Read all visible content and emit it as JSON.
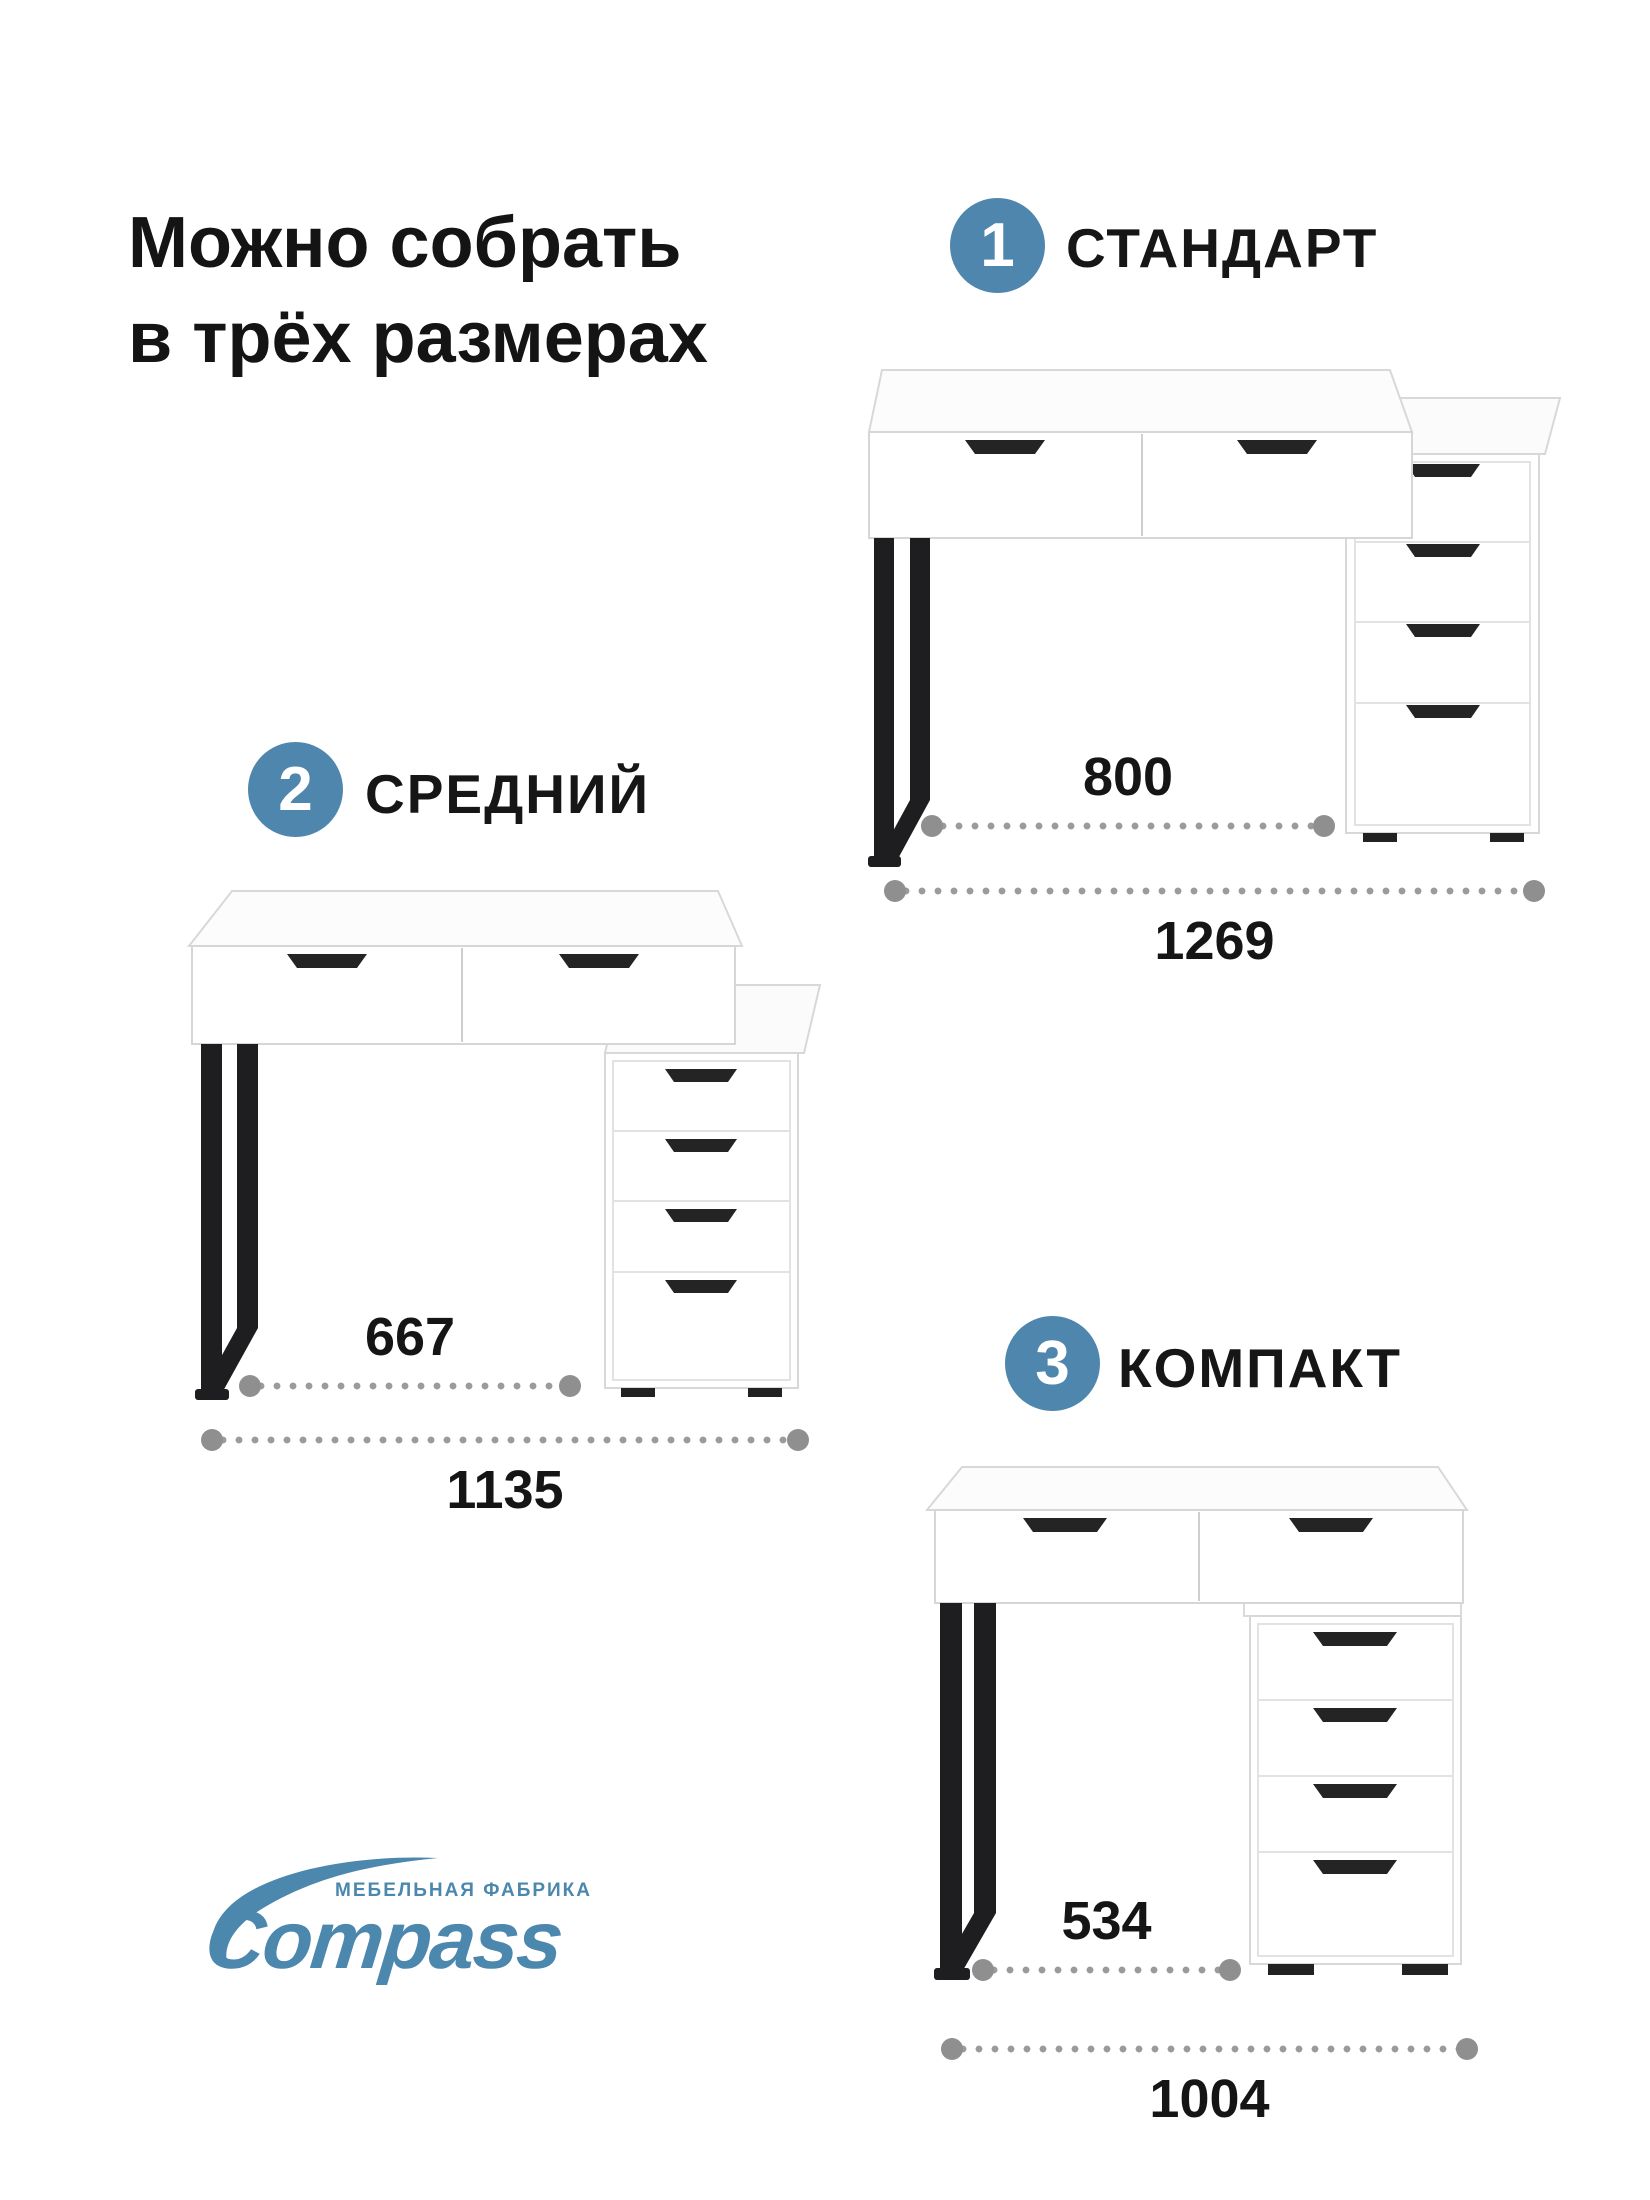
{
  "title": {
    "line1": "Можно собрать",
    "line2": "в трёх размерах"
  },
  "colors": {
    "accent_blue": "#4f86ad",
    "logo_blue": "#4c87ae",
    "dot_gray": "#9b9b9b",
    "text": "#161616"
  },
  "variants": [
    {
      "number": "1",
      "label": "СТАНДАРТ",
      "inner_width": "800",
      "outer_width": "1269"
    },
    {
      "number": "2",
      "label": "СРЕДНИЙ",
      "inner_width": "667",
      "outer_width": "1135"
    },
    {
      "number": "3",
      "label": "КОМПАКТ",
      "inner_width": "534",
      "outer_width": "1004"
    }
  ],
  "logo": {
    "tagline": "МЕБЕЛЬНАЯ ФАБРИКА",
    "brand": "Compass"
  }
}
